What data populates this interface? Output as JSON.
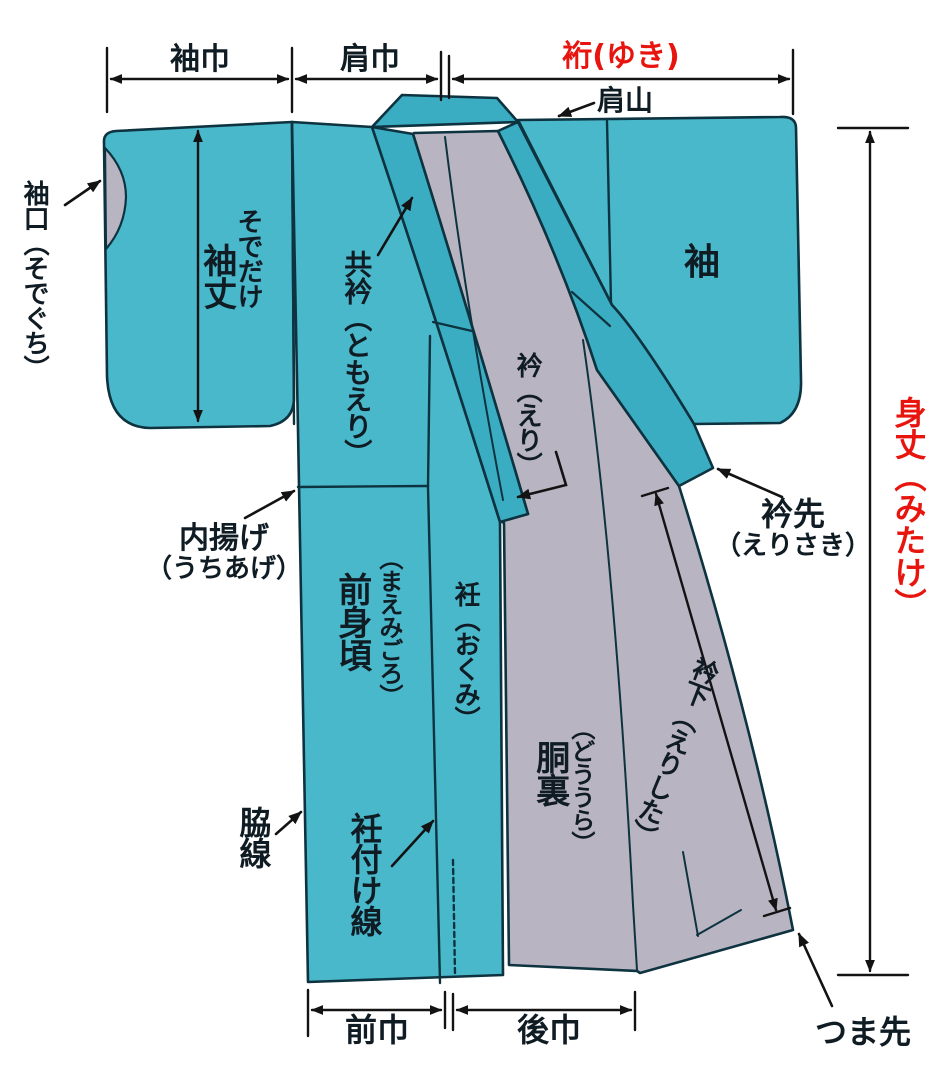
{
  "diagram_title": "kimono-parts-diagram",
  "colors": {
    "fabric_teal": "#4ab8cb",
    "collar_teal": "#3badc2",
    "lining_gray": "#b9b4c1",
    "outline_dark": "#0e3340",
    "dimension_black": "#131313",
    "accent_red": "#e8150f",
    "label_dark": "#101c24"
  },
  "top_dimensions": {
    "sode_haba": "袖巾",
    "kata_haba": "肩巾",
    "yuki": "裄(ゆき)"
  },
  "side_dimension": {
    "mitake": "身丈（みたけ）"
  },
  "bottom_dimensions": {
    "mae_haba": "前巾",
    "ushiro_haba": "後巾"
  },
  "labels": {
    "kata_yama": "肩山",
    "sode_guchi": "袖口（そでぐち）",
    "sode_take": "袖丈",
    "sode_take_kana": "そでだけ",
    "tomoeri": "共衿（ともえり）",
    "eri": "衿（えり）",
    "sode": "袖",
    "uchiage_main": "内揚げ",
    "uchiage_kana": "（うちあげ）",
    "erisaki_main": "衿先",
    "erisaki_kana": "（えりさき）",
    "mae_migoro": "前身頃",
    "mae_migoro_kana": "（まえみごろ）",
    "okumi": "衽（おくみ）",
    "do_ura": "胴裏",
    "do_ura_kana": "（どううら）",
    "eri_shita": "衿下（えりした）",
    "waki_sen": "脇線",
    "okumi_tsuke_sen": "衽付け線",
    "tsuma_saki": "つま先"
  }
}
